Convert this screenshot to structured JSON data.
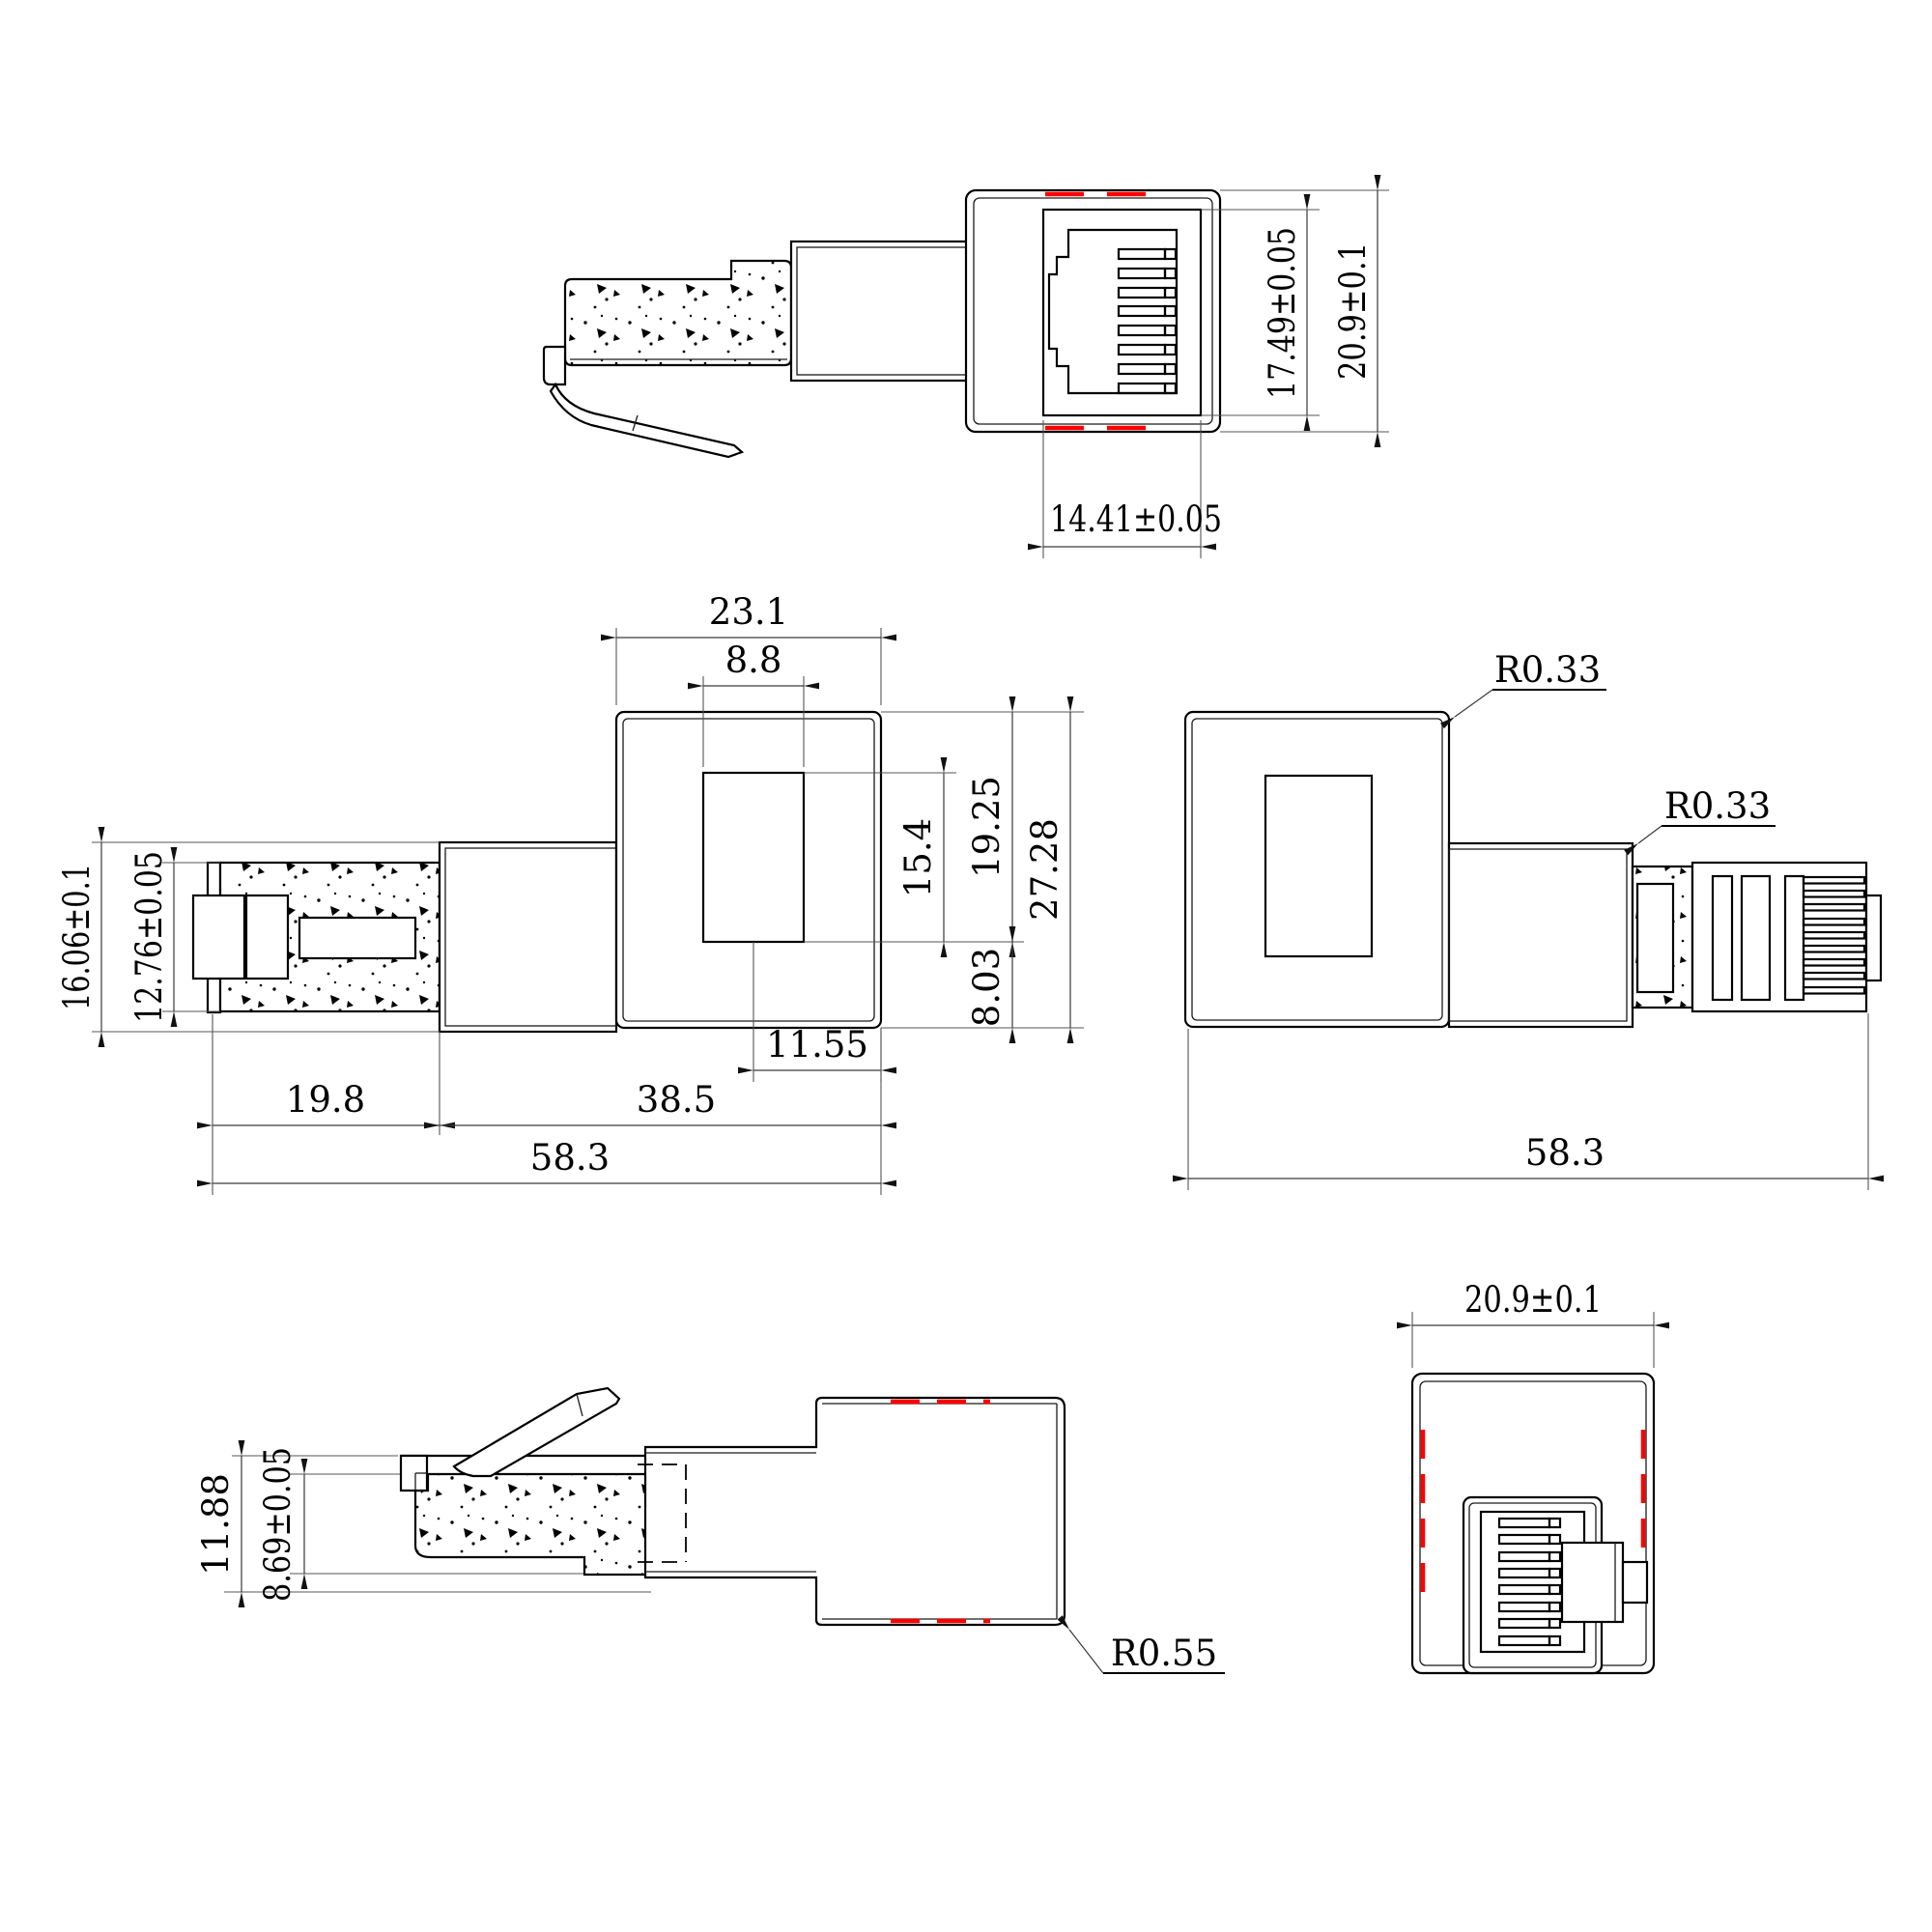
{
  "drawing": {
    "type": "cad-orthographic-views",
    "subject": "RJ45 right-angle adapter (plug to jack) dimensional drawing",
    "units": "mm",
    "colors": {
      "line": "#000000",
      "dimension": "#3a3a3a",
      "highlight_red": "#ff0000",
      "background": "#ffffff"
    },
    "views": {
      "front_view": {
        "name": "front view (jack face with plug side profile)",
        "socket_width": "14.41±0.05",
        "socket_height": "17.49±0.05",
        "overall_height": "20.9±0.1"
      },
      "top_view": {
        "name": "top view (plug left, body right)",
        "body_width": "23.1",
        "window_width": "8.8",
        "plug_section_height": "16.06±0.1",
        "plug_body_height": "12.76±0.05",
        "window_height": "15.4",
        "upper_height": "19.25",
        "lower_height": "8.03",
        "total_height": "27.28",
        "window_offset": "11.55",
        "plug_length": "19.8",
        "body_length": "38.5",
        "total_length": "58.3"
      },
      "bottom_view": {
        "name": "opposite top view (body left, plug right)",
        "corner_radius_body": "R0.33",
        "corner_radius_neck": "R0.33",
        "total_length": "58.3"
      },
      "side_view": {
        "name": "side view (latch up)",
        "overall_height": "11.88",
        "plug_height": "8.69±0.05",
        "corner_radius": "R0.55"
      },
      "rear_view": {
        "name": "rear view",
        "overall_width": "20.9±0.1"
      }
    }
  }
}
